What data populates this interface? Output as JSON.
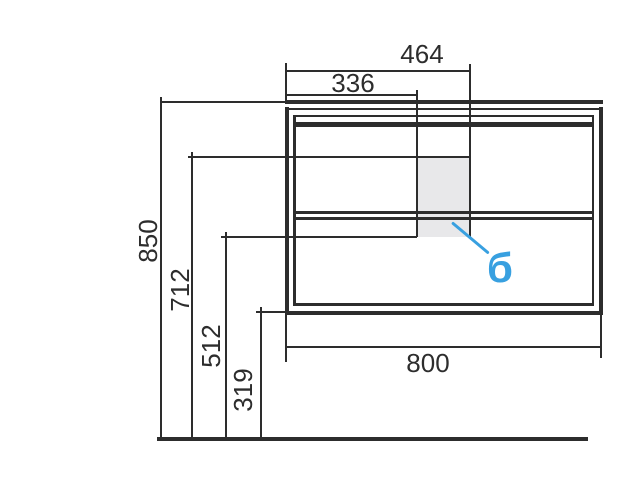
{
  "drawing": {
    "kind": "cabinet-front-elevation-dimension-drawing",
    "dimensions": {
      "d464": "464",
      "d336": "336",
      "d850": "850",
      "d712": "712",
      "d512": "512",
      "d319": "319",
      "d800": "800"
    },
    "callout": {
      "label": "б"
    },
    "colors": {
      "line": "#2d2d2d",
      "text": "#2d2d2d",
      "shade": "#e8e8ea",
      "callout": "#38a0e0"
    }
  }
}
